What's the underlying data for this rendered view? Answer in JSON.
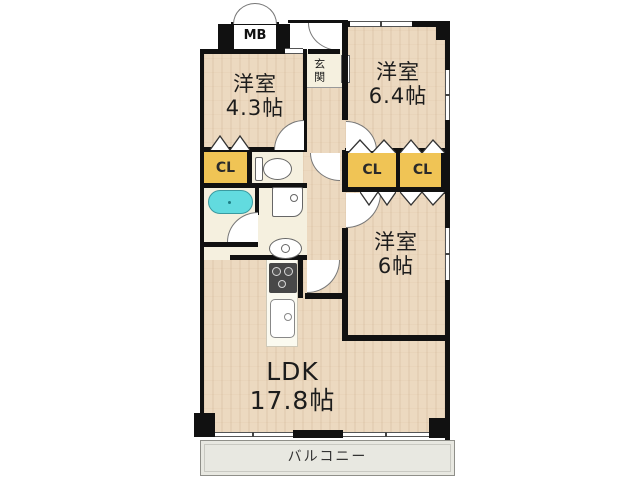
{
  "colors": {
    "wall": "#111111",
    "wood_floor": "#ecd9c0",
    "tile_floor": "#f5f0df",
    "closet_yellow": "#f0c455",
    "bathtub_cyan": "#62dbdf",
    "balcony_gray": "#e8e8e1"
  },
  "plan": {
    "meter_box_label": "MB",
    "entrance_label": "玄関",
    "rooms": [
      {
        "id": "room-4-3",
        "name": "洋室",
        "size": "4.3帖"
      },
      {
        "id": "room-6-4",
        "name": "洋室",
        "size": "6.4帖"
      },
      {
        "id": "room-6",
        "name": "洋室",
        "size": "6帖"
      },
      {
        "id": "ldk",
        "name": "LDK",
        "size": "17.8帖"
      }
    ],
    "closets": [
      {
        "label": "CL"
      },
      {
        "label": "CL"
      },
      {
        "label": "CL"
      }
    ],
    "balcony_label": "バルコニー",
    "fixtures": [
      "meter-box-doors",
      "entrance-door",
      "toilet",
      "bathtub",
      "vanity-sink",
      "washing-machine-pan",
      "gas-stove",
      "kitchen-sink",
      "folding-closet-doors",
      "sliding-windows"
    ]
  }
}
